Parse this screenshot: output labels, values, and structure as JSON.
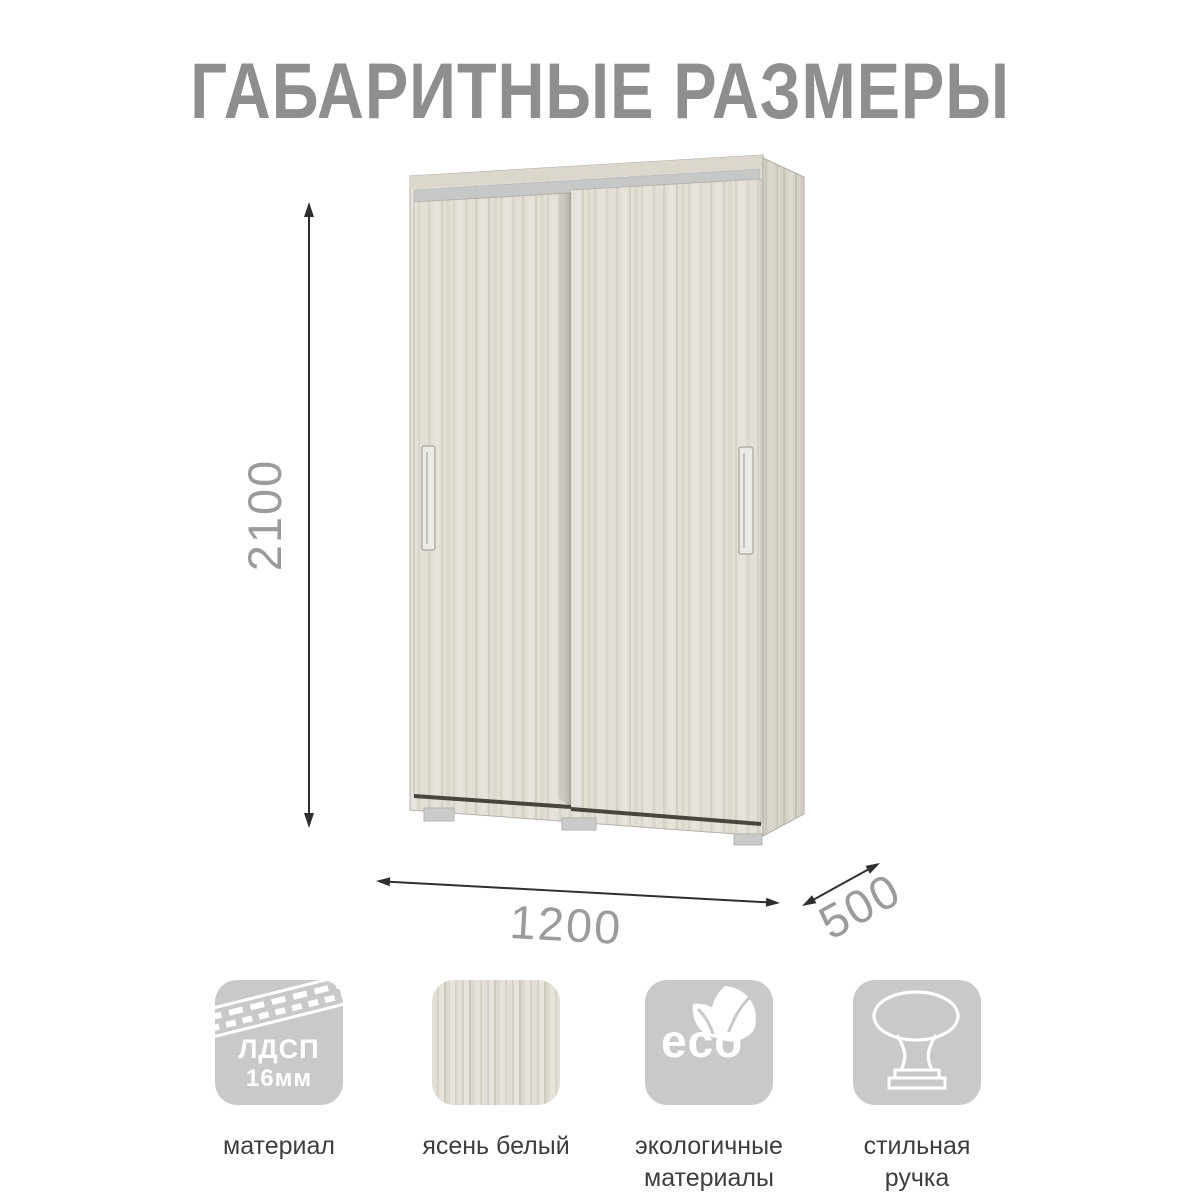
{
  "title": "ГАБАРИТНЫЕ РАЗМЕРЫ",
  "dimensions": {
    "height": "2100",
    "width": "1200",
    "depth": "500"
  },
  "features": [
    {
      "icon": "chipboard-icon",
      "icon_lines": [
        "ЛДСП",
        "16мм"
      ],
      "caption_lines": [
        "материал"
      ]
    },
    {
      "icon": "wood-swatch-icon",
      "caption_lines": [
        "ясень белый"
      ]
    },
    {
      "icon": "eco-icon",
      "icon_text": "eco",
      "caption_lines": [
        "экологичные",
        "материалы"
      ]
    },
    {
      "icon": "handle-knob-icon",
      "caption_lines": [
        "стильная",
        "ручка"
      ]
    }
  ],
  "colors": {
    "title_gray": "#8e8e8e",
    "dimension_label_gray": "#9b9b9b",
    "dimension_line": "#2f2f2f",
    "tile_gray": "#c9c9c9",
    "caption_text": "#3e3e3e",
    "wood_base": "#e3dfd7",
    "wood_side": "#d7d3c9",
    "top_rail_gray": "#c6c8c7"
  }
}
